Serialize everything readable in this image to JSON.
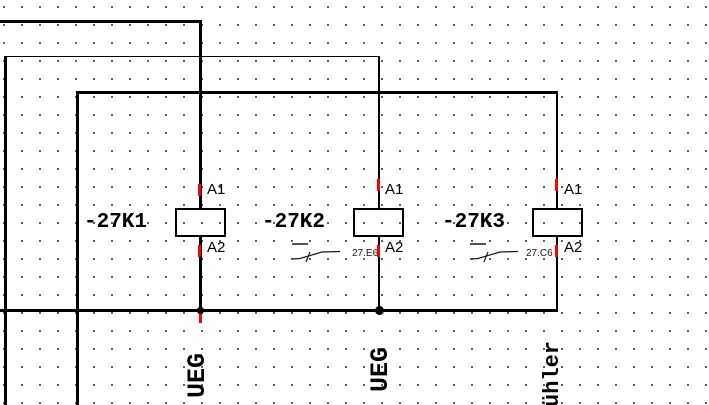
{
  "schematic": {
    "coils": [
      {
        "name": "-27K1",
        "terminal_top": "A1",
        "terminal_bottom": "A2",
        "crossref": null
      },
      {
        "name": "-27K2",
        "terminal_top": "A1",
        "terminal_bottom": "A2",
        "crossref": "27.E6"
      },
      {
        "name": "-27K3",
        "terminal_top": "A1",
        "terminal_bottom": "A2",
        "crossref": "27.C6"
      }
    ],
    "wire_labels": [
      {
        "text": "UEG"
      },
      {
        "text": "UEG"
      },
      {
        "text": "ühler"
      }
    ],
    "colors": {
      "wire": "#000000",
      "connection_marker": "#ff0000",
      "grid_dot": "#404040",
      "background": "#ffffff",
      "text": "#000000",
      "crossref_text": "#1a1a1a"
    }
  }
}
